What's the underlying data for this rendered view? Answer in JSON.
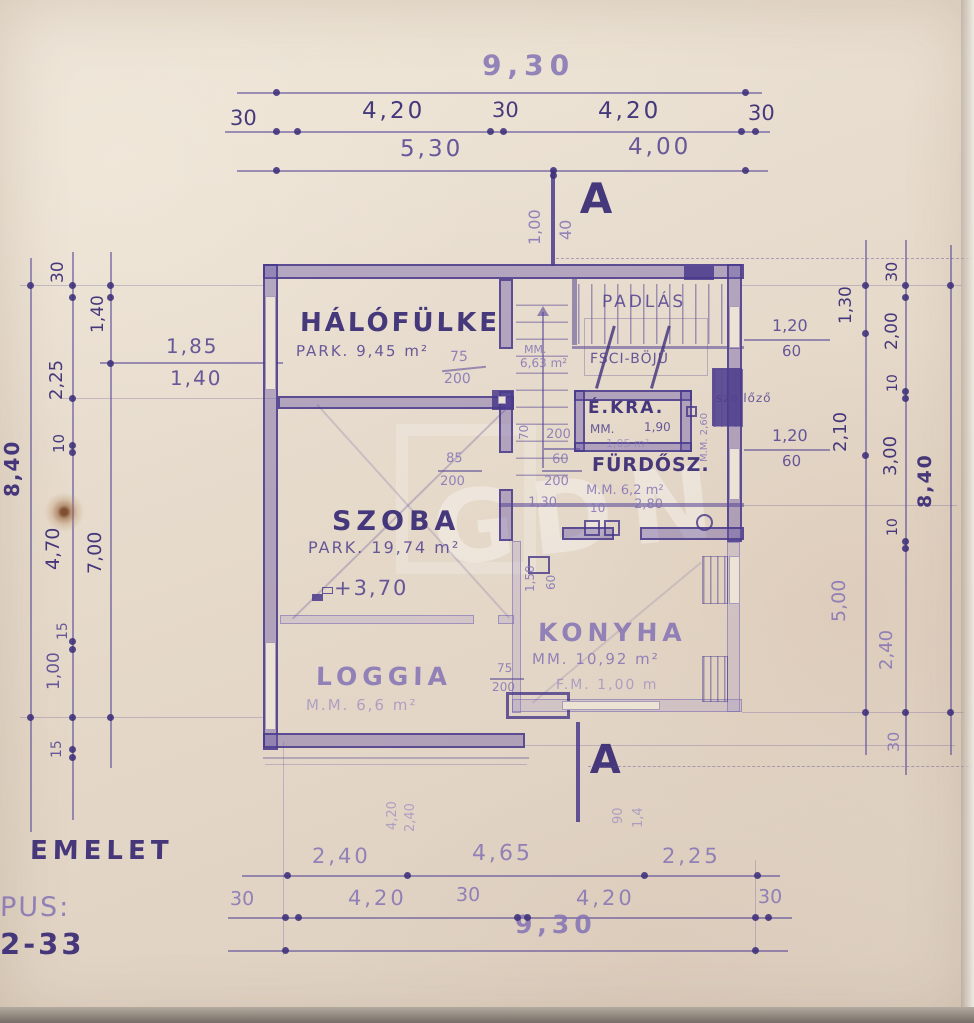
{
  "title": {
    "floor": "EMELET",
    "type_label": "PUS:",
    "type_number": "2-33"
  },
  "section": {
    "label": "A",
    "top_dims": [
      "1,00",
      "40"
    ],
    "bottom_dims": [
      "90",
      "1,4"
    ],
    "bottom_left_dims": [
      "4,20",
      "2,40"
    ]
  },
  "watermark": "GDN",
  "rooms": {
    "halofulke": {
      "name": "HÁLÓFÜLKE",
      "area": "PARK. 9,45 m²"
    },
    "padlas": {
      "name": "PADLÁS",
      "stair": "FSCI-BÖJÜ"
    },
    "hall": {
      "mm": "MM.",
      "area": "6,63 m²"
    },
    "kamra": {
      "name": "É.KRA.",
      "mm": "MM.",
      "dim": "1,90",
      "area": "1,05 m²"
    },
    "kamra_side": "M.M. 2,60",
    "szellozo": "szellőző",
    "furdo": {
      "name": "FÜRDŐSZ.",
      "area": "M.M. 6,2 m²",
      "d1": "10",
      "d2": "2,80"
    },
    "szoba": {
      "name": "SZOBA",
      "area": "PARK. 19,74 m²",
      "level": "+3,70"
    },
    "konyha": {
      "name": "KONYHA",
      "area": "MM. 10,92 m²",
      "note": "F.M. 1,00 m"
    },
    "loggia": {
      "name": "LOGGIA",
      "area": "M.M. 6,6 m²"
    }
  },
  "dims": {
    "top": {
      "total": "9,30",
      "row2": [
        "30",
        "4,20",
        "30",
        "4,20",
        "30"
      ],
      "row3": [
        "5,30",
        "4,00"
      ]
    },
    "bottom": {
      "row1": [
        "2,40",
        "4,65",
        "2,25"
      ],
      "row2": [
        "30",
        "4,20",
        "30",
        "4,20",
        "30"
      ],
      "total": "9,30"
    },
    "left": {
      "outer": "8,40",
      "chain": [
        "30",
        "2,25",
        "10",
        "4,70",
        "15",
        "1,00",
        "15"
      ],
      "inner": [
        "1,40",
        "7,00"
      ],
      "window": [
        "1,85",
        "1,40"
      ]
    },
    "right": {
      "outer": "8,40",
      "inner": [
        "1,30",
        "2,10",
        "5,00"
      ],
      "chain": [
        "30",
        "2,00",
        "10",
        "3,00",
        "10",
        "2,40",
        "30"
      ],
      "fr1": [
        "1,20",
        "60"
      ],
      "fr2": [
        "1,20",
        "60"
      ]
    },
    "inner": {
      "door1": [
        "75",
        "200"
      ],
      "door2": [
        "85",
        "200"
      ],
      "stack": [
        "200",
        "60",
        "200"
      ],
      "w130": "1,30",
      "v70": "70",
      "k_top": [
        "1,50",
        "60"
      ],
      "k_door": [
        "75",
        "200"
      ]
    }
  }
}
